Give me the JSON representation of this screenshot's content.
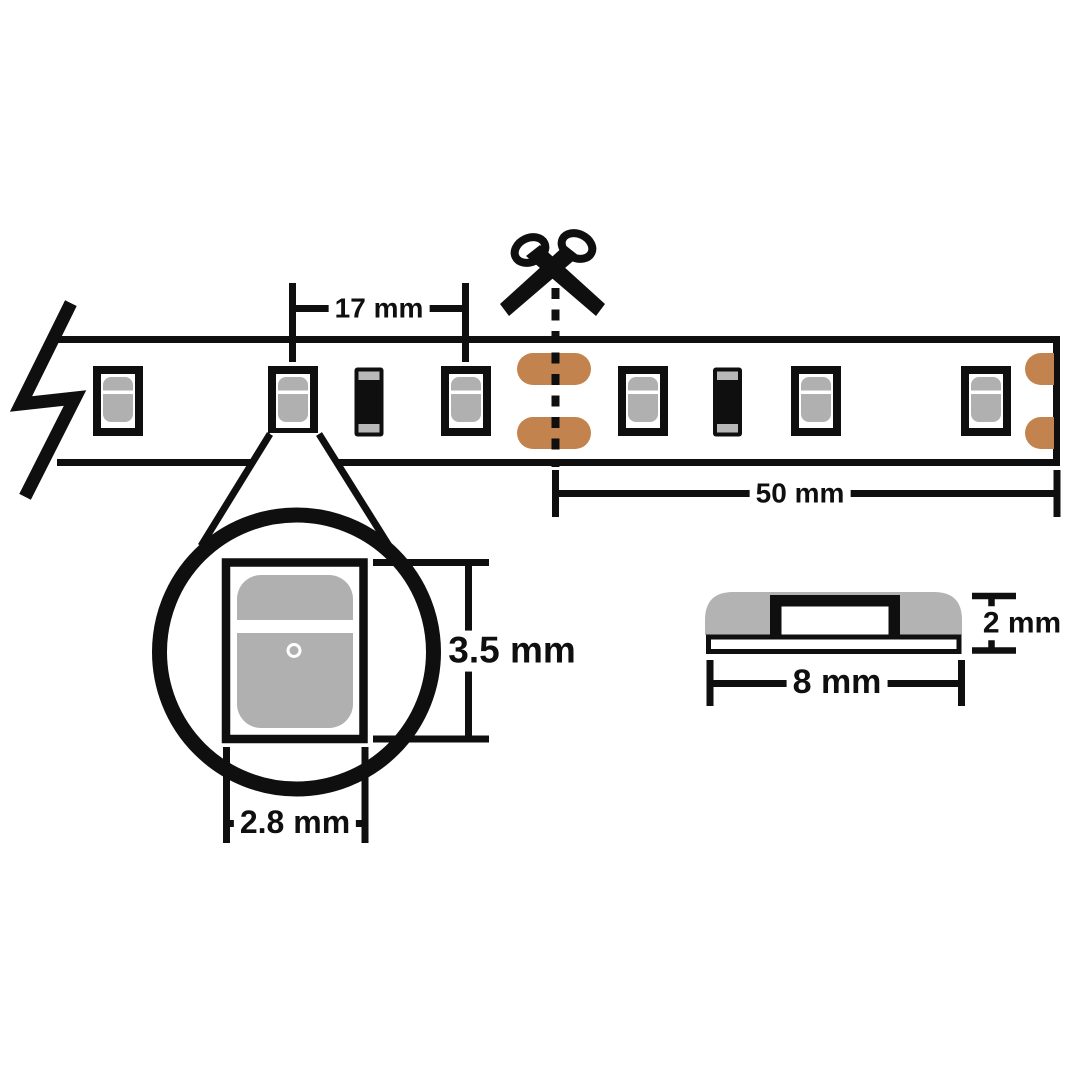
{
  "canvas": {
    "background": "#ffffff",
    "line_color": "#0f0f0f"
  },
  "colors": {
    "led_body_gray": "#b0b0b0",
    "copper_pad": "#c3834e",
    "resistor_cap_gray": "#b8b8b8",
    "silicone_dome_gray": "#b3b3b3"
  },
  "strip": {
    "led_count": 6,
    "resistor_count": 2,
    "pitch_label": "17 mm",
    "cut_length_label": "50 mm",
    "icons": {
      "scissors": "scissors-icon",
      "cut_line": "cut-dashed-line",
      "break": "strip-break-icon"
    }
  },
  "led_detail": {
    "height_label": "3.5 mm",
    "width_label": "2.8 mm"
  },
  "side_profile": {
    "height_label": "2 mm",
    "width_label": "8 mm"
  }
}
